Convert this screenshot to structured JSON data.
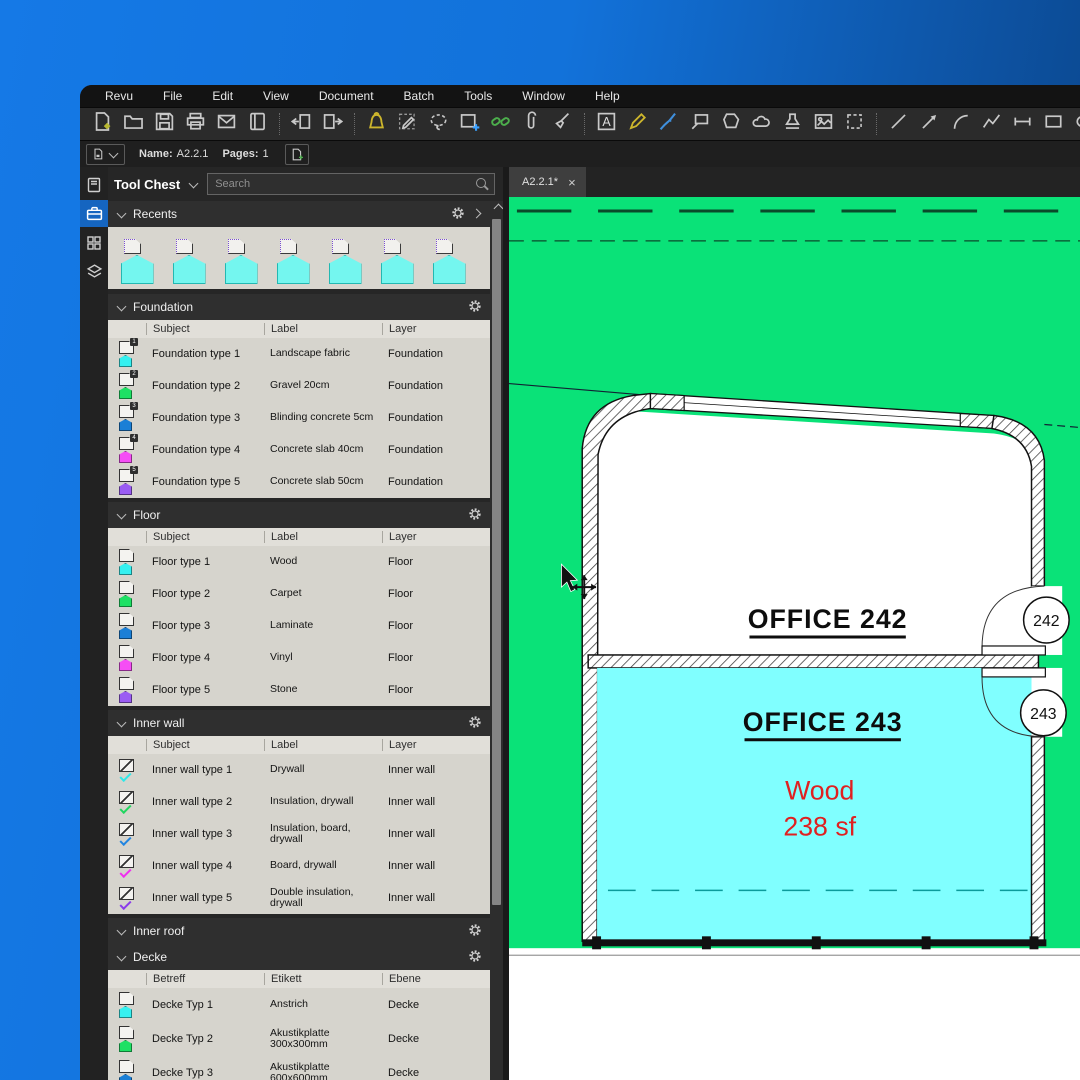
{
  "window": {
    "menu": [
      "Revu",
      "File",
      "Edit",
      "View",
      "Document",
      "Batch",
      "Tools",
      "Window",
      "Help"
    ]
  },
  "toolbar_main": {
    "icons": [
      {
        "n": "new-file-icon"
      },
      {
        "n": "open-folder-icon"
      },
      {
        "n": "save-icon"
      },
      {
        "n": "print-icon"
      },
      {
        "n": "email-icon"
      },
      {
        "n": "profile-icon"
      },
      {
        "n": "sep"
      },
      {
        "n": "import-pages-icon"
      },
      {
        "n": "export-pages-icon"
      },
      {
        "n": "sep"
      },
      {
        "n": "alert-icon",
        "c": "#cdb62c"
      },
      {
        "n": "markup-editor-icon"
      },
      {
        "n": "lasso-icon"
      },
      {
        "n": "markup-add-icon"
      },
      {
        "n": "hyperlink-icon",
        "c": "#4cae4c"
      },
      {
        "n": "attachment-icon"
      },
      {
        "n": "erase-icon"
      },
      {
        "n": "sep"
      },
      {
        "n": "textbox-icon"
      },
      {
        "n": "pencil-icon",
        "c": "#cdb62c"
      },
      {
        "n": "pen-icon",
        "c": "#3f8fdc"
      },
      {
        "n": "callout-icon"
      },
      {
        "n": "polygon-icon"
      },
      {
        "n": "cloud-icon"
      },
      {
        "n": "stamp-icon"
      },
      {
        "n": "image-icon"
      },
      {
        "n": "snapshot-icon"
      },
      {
        "n": "sep"
      },
      {
        "n": "line-icon"
      },
      {
        "n": "arrow-icon"
      },
      {
        "n": "arc-icon"
      },
      {
        "n": "polyline-icon"
      },
      {
        "n": "dimension-icon"
      },
      {
        "n": "rectangle-icon"
      },
      {
        "n": "ellipse-icon"
      }
    ]
  },
  "toolbar_file": {
    "name_label": "Name:",
    "name_value": "A2.2.1",
    "pages_label": "Pages:",
    "pages_value": "1"
  },
  "tool_chest": {
    "title": "Tool Chest",
    "search_placeholder": "Search",
    "recents_title": "Recents",
    "recents_count": 7,
    "sections": [
      {
        "title": "Foundation",
        "columns": [
          "Subject",
          "Label",
          "Layer"
        ],
        "icon_style": "badge",
        "rows": [
          {
            "subject": "Foundation type 1",
            "label": "Landscape fabric",
            "layer": "Foundation",
            "color": "#35f0f0",
            "badge": "1"
          },
          {
            "subject": "Foundation type 2",
            "label": "Gravel 20cm",
            "layer": "Foundation",
            "color": "#1ee064",
            "badge": "2"
          },
          {
            "subject": "Foundation type 3",
            "label": "Blinding concrete 5cm",
            "layer": "Foundation",
            "color": "#1b7fd6",
            "badge": "3"
          },
          {
            "subject": "Foundation type 4",
            "label": "Concrete slab 40cm",
            "layer": "Foundation",
            "color": "#f54ef5",
            "badge": "4"
          },
          {
            "subject": "Foundation type 5",
            "label": "Concrete slab 50cm",
            "layer": "Foundation",
            "color": "#9a5cf2",
            "badge": "5"
          }
        ]
      },
      {
        "title": "Floor",
        "columns": [
          "Subject",
          "Label",
          "Layer"
        ],
        "icon_style": "poly",
        "rows": [
          {
            "subject": "Floor type 1",
            "label": "Wood",
            "layer": "Floor",
            "color": "#35f0f0"
          },
          {
            "subject": "Floor type 2",
            "label": "Carpet",
            "layer": "Floor",
            "color": "#1ee064"
          },
          {
            "subject": "Floor type 3",
            "label": "Laminate",
            "layer": "Floor",
            "color": "#1b7fd6"
          },
          {
            "subject": "Floor type 4",
            "label": "Vinyl",
            "layer": "Floor",
            "color": "#f54ef5"
          },
          {
            "subject": "Floor type 5",
            "label": "Stone",
            "layer": "Floor",
            "color": "#9a5cf2"
          }
        ]
      },
      {
        "title": "Inner wall",
        "columns": [
          "Subject",
          "Label",
          "Layer"
        ],
        "icon_style": "check",
        "rows": [
          {
            "subject": "Inner wall type 1",
            "label": "Drywall",
            "layer": "Inner wall",
            "color": "#2fe8e8"
          },
          {
            "subject": "Inner wall type 2",
            "label": "Insulation, drywall",
            "layer": "Inner wall",
            "color": "#21d75f"
          },
          {
            "subject": "Inner wall type 3",
            "label": "Insulation, board, drywall",
            "layer": "Inner wall",
            "color": "#2285e0"
          },
          {
            "subject": "Inner wall type 4",
            "label": "Board, drywall",
            "layer": "Inner wall",
            "color": "#ef2fef"
          },
          {
            "subject": "Inner wall type 5",
            "label": "Double insulation, drywall",
            "layer": "Inner wall",
            "color": "#8a3cea"
          }
        ]
      },
      {
        "title": "Inner roof",
        "columns": [],
        "icon_style": "poly",
        "rows": []
      },
      {
        "title": "Decke",
        "columns": [
          "Betreff",
          "Etikett",
          "Ebene"
        ],
        "icon_style": "poly",
        "tall": true,
        "rows": [
          {
            "subject": "Decke Typ 1",
            "label": "Anstrich",
            "layer": "Decke",
            "color": "#35f0f0"
          },
          {
            "subject": "Decke Typ 2",
            "label": "Akustikplatte 300x300mm",
            "layer": "Decke",
            "color": "#1ee064"
          },
          {
            "subject": "Decke Typ 3",
            "label": "Akustikplatte 600x600mm",
            "layer": "Decke",
            "color": "#1b7fd6"
          }
        ]
      }
    ]
  },
  "document_tab": {
    "label": "A2.2.1*",
    "close": "×"
  },
  "drawing": {
    "room1": "OFFICE  242",
    "room2": "OFFICE  243",
    "material": "Wood",
    "area": "238 sf",
    "badge1": "242",
    "badge2": "243",
    "colors": {
      "site_green": "#0ae278",
      "room2_cyan": "#80ffff",
      "annotation_red": "#e02020"
    }
  }
}
